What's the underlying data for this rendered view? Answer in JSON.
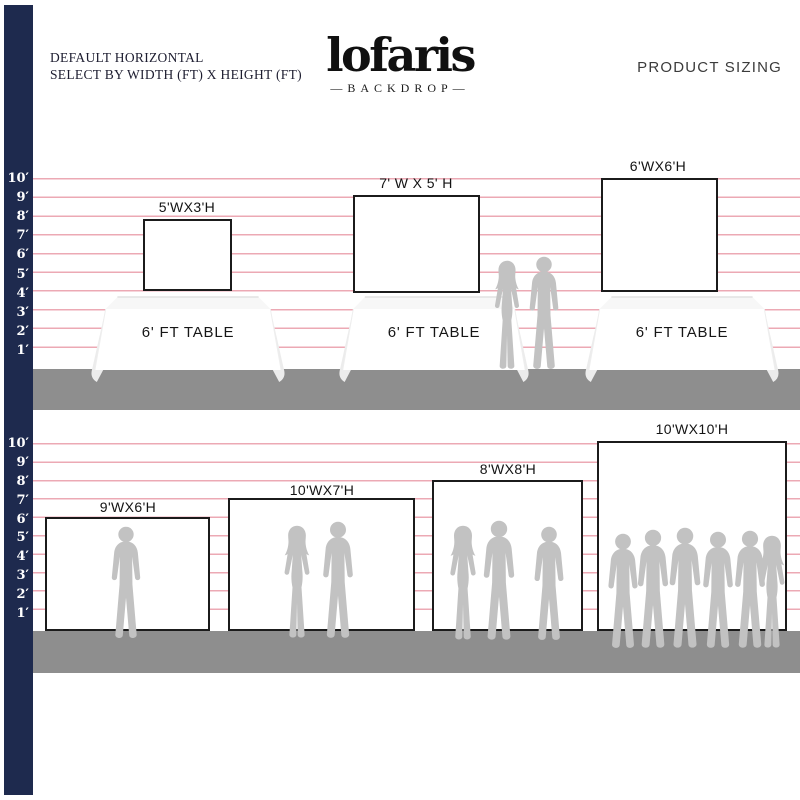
{
  "header": {
    "line1": "DEFAULT HORIZONTAL",
    "line2": "SELECT BY WIDTH (FT) X HEIGHT (FT)",
    "logo": "lofaris",
    "logo_dash": "—",
    "logo_sub": "BACKDROP",
    "product_sizing": "PRODUCT SIZING"
  },
  "ruler": {
    "feet": [
      "10′",
      "9′",
      "8′",
      "7′",
      "6′",
      "5′",
      "4′",
      "3′",
      "2′",
      "1′"
    ]
  },
  "row1": {
    "description": "backdrops displayed on tables",
    "backdrops": [
      {
        "label": "5'WX3'H",
        "width_ft": 5,
        "height_ft": 3,
        "table": "6' FT TABLE"
      },
      {
        "label": "7' W X 5' H",
        "width_ft": 7,
        "height_ft": 5,
        "table": "6' FT TABLE"
      },
      {
        "label": "6'WX6'H",
        "width_ft": 6,
        "height_ft": 6,
        "table": "6' FT TABLE"
      }
    ]
  },
  "row2": {
    "description": "backdrops displayed on floor with people for scale",
    "backdrops": [
      {
        "label": "9'WX6'H",
        "width_ft": 9,
        "height_ft": 6
      },
      {
        "label": "10'WX7'H",
        "width_ft": 10,
        "height_ft": 7
      },
      {
        "label": "8'WX8'H",
        "width_ft": 8,
        "height_ft": 8
      },
      {
        "label": "10'WX10'H",
        "width_ft": 10,
        "height_ft": 10
      }
    ]
  },
  "colors": {
    "navy_bar": "#1e2a4e",
    "grid_pink": "#eca9b4",
    "floor_gray": "#8e8e8e",
    "silhouette_gray": "#c2c2c2",
    "backdrop_border": "#1b1b1b"
  }
}
